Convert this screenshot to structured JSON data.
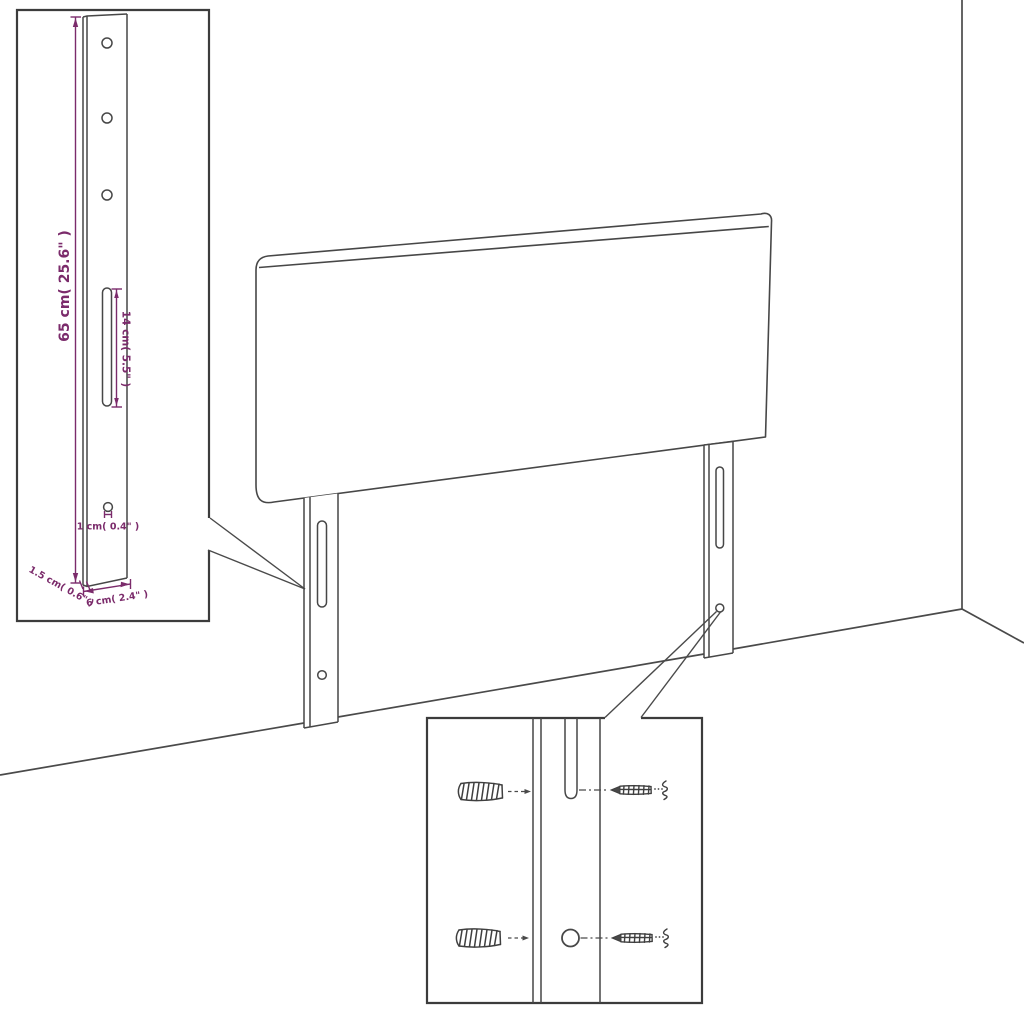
{
  "diagram": {
    "kind": "furniture-assembly-dimension-diagram",
    "subject": "upholstered headboard with two slotted mounting legs, wall-fixing detail",
    "colors": {
      "line": "#474747",
      "dimension_accent": "#7b2b6b",
      "background": "#ffffff"
    },
    "leg_detail_inset": {
      "height_label": "65 cm( 25.6\" )",
      "slot_length_label": "14 cm( 5.5\" )",
      "hole_label": "1 cm( 0.4\" )",
      "depth_label": "1.5 cm( 0.6\" )",
      "width_label": "6 cm( 2.4\" )",
      "hole_count": 3,
      "features": [
        "three screw holes",
        "long adjustment slot",
        "small lower hole"
      ]
    },
    "hardware_detail_inset": {
      "items": [
        "wall-plug",
        "wall-plug",
        "screw",
        "screw"
      ],
      "rows": 2
    }
  }
}
